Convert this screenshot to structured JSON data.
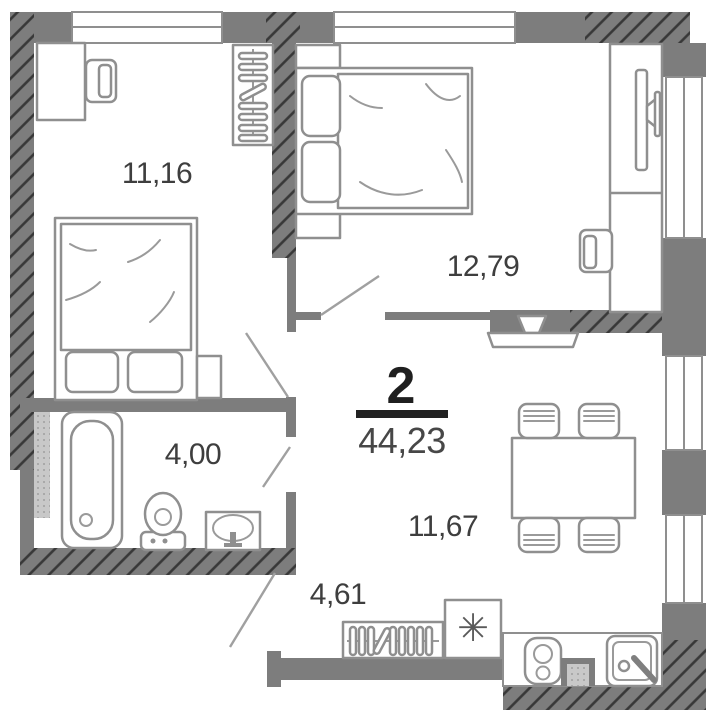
{
  "plan": {
    "summary": {
      "rooms_count": "2",
      "total_area": "44,23"
    },
    "areas": {
      "bedroom_top_left": "11,16",
      "bedroom_top_right": "12,79",
      "bathroom": "4,00",
      "hallway": "4,61",
      "living_kitchen": "11,67"
    },
    "symbols": {
      "fridge": "✳"
    },
    "colors": {
      "wall": "#7d7d7d",
      "hatch_line": "#383838",
      "furniture_line": "#8f8f8f",
      "shaft_fill": "#c8c8c8",
      "label_text": "#3e3e3e",
      "summary_text": "#1f1f1f"
    }
  }
}
